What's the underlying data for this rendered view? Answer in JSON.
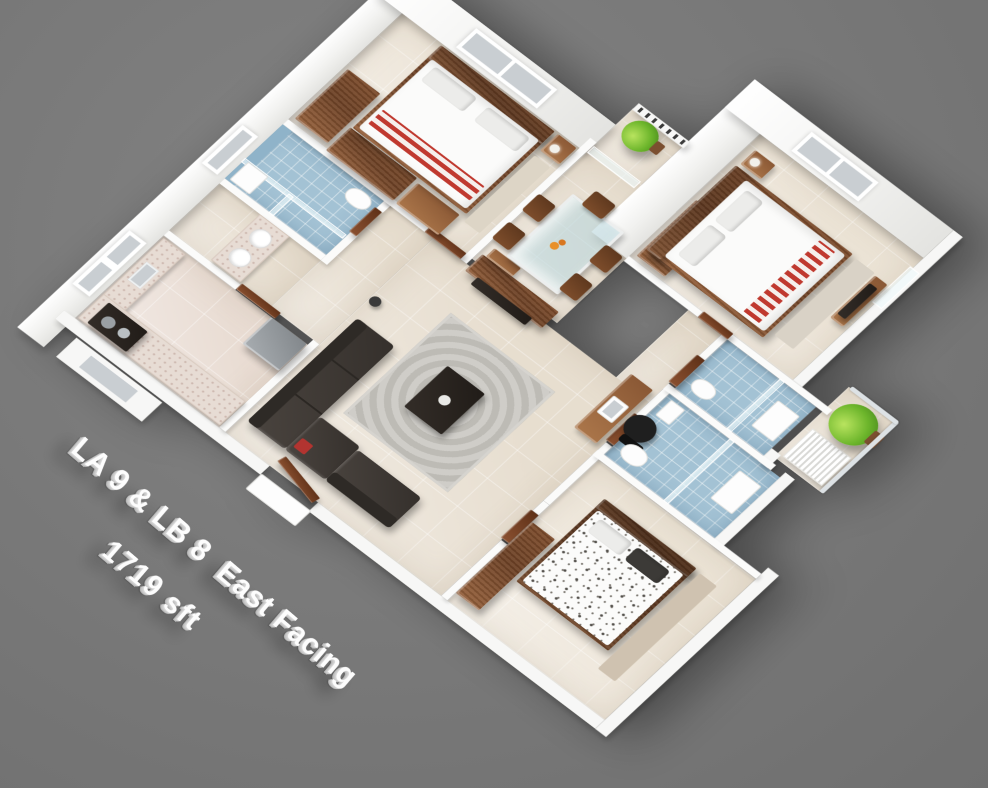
{
  "canvas": {
    "width": 988,
    "height": 788,
    "background_color": "#7a7a7a"
  },
  "caption": {
    "line1": "LA 9 & LB 8  East Facing",
    "line2": "1719 sft",
    "text_color": "#ffffff",
    "rotation_deg": 40.5
  },
  "unit_info": {
    "unit_labels": "LA 9 & LB 8",
    "facing": "East Facing",
    "area": "1719 sft"
  },
  "palette": {
    "background_gray": "#7a7a7a",
    "wall_white": "#f7f7f6",
    "floor_cream": "#ece4d8",
    "bath_tile_blue": "#a3c2d4",
    "wood_brown": "#7c4f2e",
    "sofa_dark_brown": "#443f3a",
    "rug_gray": "#c6c4bf",
    "stripe_red": "#c0392f",
    "plant_green": "#6cb52b",
    "glass_blue": "#b9d6dc"
  },
  "scene": {
    "type": "isometric-3d-floor-plan-render",
    "rooms": [
      "kitchen",
      "utility-passage",
      "bathroom-1",
      "bedroom-1",
      "dining",
      "sit-out-balcony",
      "living-room",
      "study-nook",
      "master-bedroom",
      "bathroom-2",
      "bathroom-3",
      "utility-balcony",
      "bedroom-3"
    ],
    "furniture": [
      "l-shaped-sofa",
      "area-rug",
      "coffee-table",
      "tv-partition-panel",
      "glass-dining-table-with-chairs",
      "double-bed-red-runner",
      "double-bed-master",
      "double-bed-floral",
      "wardrobes",
      "kitchen-counter-with-stove",
      "refrigerator",
      "wash-vanity-two-basins",
      "study-desk-with-chair",
      "potted-plants",
      "balcony-railings",
      "glass-shower-partitions"
    ]
  }
}
